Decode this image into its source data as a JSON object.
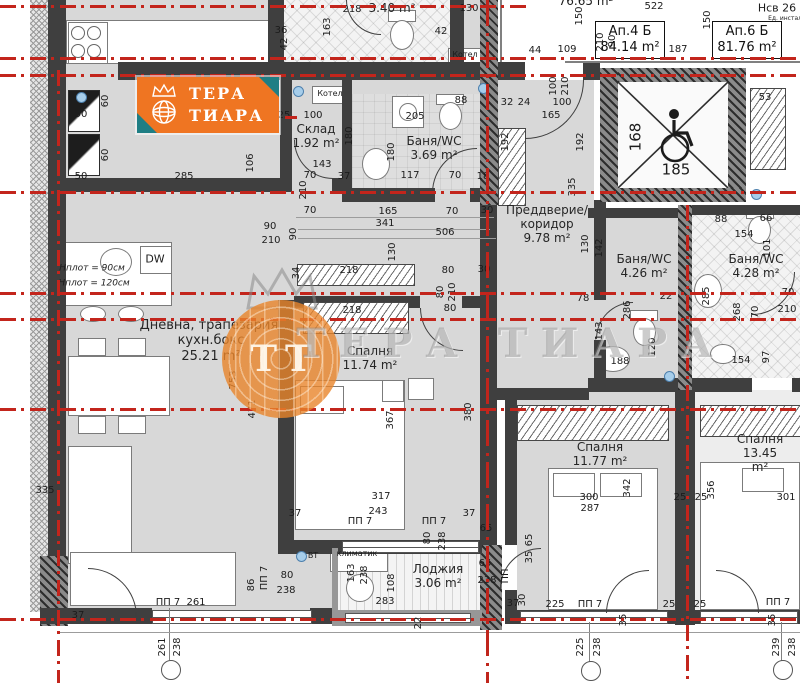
{
  "logo": {
    "line1": "ТЕРА",
    "line2": "ТИАРА"
  },
  "watermark": {
    "initials": "ТТ",
    "text": "ТЕРА ТИАРА"
  },
  "apartments": [
    {
      "name": "Ап.4 Б",
      "area": "84.14 m²"
    },
    {
      "name": "Ап.6 Б",
      "area": "81.76 m²"
    }
  ],
  "rooms": [
    {
      "name": "",
      "area": "3.40 m²",
      "x": 392,
      "y": 1,
      "fs": 12
    },
    {
      "name": "Склад",
      "area": "1.92 m²",
      "x": 316,
      "y": 122,
      "fs": 12
    },
    {
      "name": "Баня/WC",
      "area": "3.69 m²",
      "x": 434,
      "y": 134,
      "fs": 12
    },
    {
      "name": "Преддверие/\nкоридор",
      "area": "9.78 m²",
      "x": 547,
      "y": 203,
      "fs": 12
    },
    {
      "name": "Дневна, трапезария,\nкухн.бокс",
      "area": "25.21 m²",
      "x": 211,
      "y": 318,
      "fs": 13
    },
    {
      "name": "Спалня",
      "area": "11.74 m²",
      "x": 370,
      "y": 344,
      "fs": 12
    },
    {
      "name": "Баня/WC",
      "area": "4.26 m²",
      "x": 644,
      "y": 252,
      "fs": 12
    },
    {
      "name": "Баня/WC",
      "area": "4.28 m²",
      "x": 756,
      "y": 252,
      "fs": 12
    },
    {
      "name": "Спалня",
      "area": "11.77 m²",
      "x": 600,
      "y": 440,
      "fs": 12
    },
    {
      "name": "Спалня",
      "area": "13.45 m²",
      "x": 760,
      "y": 432,
      "fs": 12
    },
    {
      "name": "Лоджия",
      "area": "3.06 m²",
      "x": 438,
      "y": 562,
      "fs": 12
    }
  ],
  "annotations": [
    {
      "t": "218",
      "x": 352,
      "y": 10
    },
    {
      "t": "163",
      "x": 328,
      "y": 27,
      "r": -90
    },
    {
      "t": "130",
      "x": 469,
      "y": 9
    },
    {
      "t": "36",
      "x": 281,
      "y": 31
    },
    {
      "t": "42",
      "x": 285,
      "y": 44,
      "r": -90
    },
    {
      "t": "42",
      "x": 441,
      "y": 32
    },
    {
      "t": "88",
      "x": 461,
      "y": 101
    },
    {
      "t": "100",
      "x": 313,
      "y": 116
    },
    {
      "t": "25",
      "x": 284,
      "y": 116
    },
    {
      "t": "Котел",
      "x": 465,
      "y": 55,
      "s": 8
    },
    {
      "t": "Котел",
      "x": 330,
      "y": 94,
      "s": 8
    },
    {
      "t": "285",
      "x": 184,
      "y": 177
    },
    {
      "t": "60",
      "x": 106,
      "y": 101,
      "r": -90
    },
    {
      "t": "60",
      "x": 106,
      "y": 155,
      "r": -90
    },
    {
      "t": "50",
      "x": 81,
      "y": 115
    },
    {
      "t": "50",
      "x": 81,
      "y": 177
    },
    {
      "t": "106",
      "x": 251,
      "y": 163,
      "r": -90
    },
    {
      "t": "143",
      "x": 322,
      "y": 165
    },
    {
      "t": "70",
      "x": 310,
      "y": 176
    },
    {
      "t": "37",
      "x": 344,
      "y": 177
    },
    {
      "t": "210",
      "x": 304,
      "y": 190,
      "r": -90
    },
    {
      "t": "70",
      "x": 310,
      "y": 211
    },
    {
      "t": "180",
      "x": 350,
      "y": 136,
      "r": -90
    },
    {
      "t": "205",
      "x": 415,
      "y": 117
    },
    {
      "t": "180",
      "x": 392,
      "y": 152,
      "r": -90
    },
    {
      "t": "117",
      "x": 410,
      "y": 176
    },
    {
      "t": "70",
      "x": 455,
      "y": 176
    },
    {
      "t": "18",
      "x": 483,
      "y": 177
    },
    {
      "t": "165",
      "x": 388,
      "y": 212
    },
    {
      "t": "70",
      "x": 452,
      "y": 212
    },
    {
      "t": "30",
      "x": 487,
      "y": 211
    },
    {
      "t": "192",
      "x": 506,
      "y": 142,
      "r": -90
    },
    {
      "t": "192",
      "x": 581,
      "y": 142,
      "r": -90
    },
    {
      "t": "32",
      "x": 507,
      "y": 103
    },
    {
      "t": "24",
      "x": 524,
      "y": 103
    },
    {
      "t": "100",
      "x": 562,
      "y": 103
    },
    {
      "t": "165",
      "x": 551,
      "y": 116
    },
    {
      "t": "100",
      "x": 554,
      "y": 86,
      "r": -90
    },
    {
      "t": "210",
      "x": 566,
      "y": 86,
      "r": -90
    },
    {
      "t": "335",
      "x": 573,
      "y": 187,
      "r": -90
    },
    {
      "t": "130",
      "x": 586,
      "y": 244,
      "r": -90
    },
    {
      "t": "142",
      "x": 600,
      "y": 248,
      "r": -90
    },
    {
      "t": "286",
      "x": 628,
      "y": 310,
      "r": -90
    },
    {
      "t": "143",
      "x": 600,
      "y": 331,
      "r": -90
    },
    {
      "t": "120",
      "x": 653,
      "y": 347,
      "r": -90
    },
    {
      "t": "188",
      "x": 620,
      "y": 362
    },
    {
      "t": "22",
      "x": 666,
      "y": 297
    },
    {
      "t": "78",
      "x": 583,
      "y": 299
    },
    {
      "t": "285",
      "x": 707,
      "y": 296,
      "r": -90
    },
    {
      "t": "154",
      "x": 744,
      "y": 235
    },
    {
      "t": "88",
      "x": 721,
      "y": 220
    },
    {
      "t": "66",
      "x": 766,
      "y": 219
    },
    {
      "t": "101",
      "x": 768,
      "y": 248,
      "r": -90
    },
    {
      "t": "268",
      "x": 738,
      "y": 312,
      "r": -90
    },
    {
      "t": "70",
      "x": 756,
      "y": 312,
      "r": -90
    },
    {
      "t": "70",
      "x": 788,
      "y": 293
    },
    {
      "t": "210",
      "x": 787,
      "y": 310
    },
    {
      "t": "97",
      "x": 767,
      "y": 357,
      "r": -90
    },
    {
      "t": "154",
      "x": 741,
      "y": 361
    },
    {
      "t": "53",
      "x": 765,
      "y": 98
    },
    {
      "t": "168",
      "x": 636,
      "y": 137,
      "r": -90,
      "s": 15
    },
    {
      "t": "185",
      "x": 676,
      "y": 170,
      "s": 15
    },
    {
      "t": "522",
      "x": 654,
      "y": 7
    },
    {
      "t": "150",
      "x": 580,
      "y": 16,
      "r": -90
    },
    {
      "t": "150",
      "x": 708,
      "y": 20,
      "r": -90
    },
    {
      "t": "Нсв 26",
      "x": 777,
      "y": 8,
      "s": 11
    },
    {
      "t": "Ед. инстал.",
      "x": 786,
      "y": 19,
      "s": 6
    },
    {
      "t": "90",
      "x": 613,
      "y": 41,
      "r": -90
    },
    {
      "t": "210",
      "x": 601,
      "y": 42,
      "r": -90
    },
    {
      "t": "187",
      "x": 678,
      "y": 50
    },
    {
      "t": "109",
      "x": 567,
      "y": 50
    },
    {
      "t": "44",
      "x": 535,
      "y": 51
    },
    {
      "t": "76.65 m²",
      "x": 586,
      "y": 1,
      "s": 12
    },
    {
      "t": "90",
      "x": 270,
      "y": 227
    },
    {
      "t": "210",
      "x": 271,
      "y": 241
    },
    {
      "t": "90",
      "x": 294,
      "y": 234,
      "r": -90
    },
    {
      "t": "341",
      "x": 385,
      "y": 224
    },
    {
      "t": "506",
      "x": 445,
      "y": 233
    },
    {
      "t": "130",
      "x": 393,
      "y": 252,
      "r": -90
    },
    {
      "t": "34",
      "x": 297,
      "y": 273,
      "r": -90
    },
    {
      "t": "218",
      "x": 349,
      "y": 271
    },
    {
      "t": "80",
      "x": 448,
      "y": 271
    },
    {
      "t": "30",
      "x": 484,
      "y": 270
    },
    {
      "t": "80",
      "x": 441,
      "y": 292,
      "r": -90
    },
    {
      "t": "210",
      "x": 453,
      "y": 292,
      "r": -90
    },
    {
      "t": "218",
      "x": 352,
      "y": 311
    },
    {
      "t": "80",
      "x": 450,
      "y": 309
    },
    {
      "t": "471",
      "x": 253,
      "y": 409,
      "r": -90
    },
    {
      "t": "367",
      "x": 391,
      "y": 420,
      "r": -90
    },
    {
      "t": "380",
      "x": 469,
      "y": 412,
      "r": -90
    },
    {
      "t": "753",
      "x": 234,
      "y": 380,
      "r": -90
    },
    {
      "t": "335",
      "x": 45,
      "y": 491
    },
    {
      "t": "Hплот = 90см",
      "x": 92,
      "y": 269,
      "s": 9,
      "i": 1
    },
    {
      "t": "Hплот = 120см",
      "x": 94,
      "y": 284,
      "s": 9,
      "i": 1
    },
    {
      "t": "DW",
      "x": 155,
      "y": 259,
      "s": 11
    },
    {
      "t": "317",
      "x": 381,
      "y": 497
    },
    {
      "t": "243",
      "x": 378,
      "y": 512
    },
    {
      "t": "37",
      "x": 295,
      "y": 514
    },
    {
      "t": "37",
      "x": 469,
      "y": 514
    },
    {
      "t": "ПП 7",
      "x": 360,
      "y": 522
    },
    {
      "t": "ПП 7",
      "x": 434,
      "y": 522
    },
    {
      "t": "80",
      "x": 428,
      "y": 538,
      "r": -90
    },
    {
      "t": "238",
      "x": 443,
      "y": 541,
      "r": -90
    },
    {
      "t": "65",
      "x": 486,
      "y": 529
    },
    {
      "t": "65",
      "x": 485,
      "y": 564
    },
    {
      "t": "238",
      "x": 487,
      "y": 581
    },
    {
      "t": "ПП",
      "x": 506,
      "y": 576,
      "r": -90
    },
    {
      "t": "климатик",
      "x": 357,
      "y": 554,
      "s": 8
    },
    {
      "t": "163",
      "x": 352,
      "y": 573,
      "r": -90
    },
    {
      "t": "238",
      "x": 365,
      "y": 575,
      "r": -90
    },
    {
      "t": "108",
      "x": 392,
      "y": 583,
      "r": -90
    },
    {
      "t": "283",
      "x": 385,
      "y": 602
    },
    {
      "t": "22",
      "x": 419,
      "y": 623,
      "r": -90
    },
    {
      "t": "37",
      "x": 513,
      "y": 604
    },
    {
      "t": "30",
      "x": 523,
      "y": 600,
      "r": -90
    },
    {
      "t": "65",
      "x": 530,
      "y": 540,
      "r": -90
    },
    {
      "t": "35",
      "x": 530,
      "y": 557,
      "r": -90
    },
    {
      "t": "86",
      "x": 252,
      "y": 585,
      "r": -90
    },
    {
      "t": "ПП 7",
      "x": 265,
      "y": 578,
      "r": -90
    },
    {
      "t": "80",
      "x": 287,
      "y": 576
    },
    {
      "t": "238",
      "x": 286,
      "y": 591
    },
    {
      "t": "ПП 7",
      "x": 168,
      "y": 603
    },
    {
      "t": "261",
      "x": 196,
      "y": 603
    },
    {
      "t": "37",
      "x": 78,
      "y": 616
    },
    {
      "t": "261",
      "x": 163,
      "y": 647,
      "r": -90
    },
    {
      "t": "238",
      "x": 178,
      "y": 647,
      "r": -90
    },
    {
      "t": "225",
      "x": 555,
      "y": 605
    },
    {
      "t": "ПП 7",
      "x": 590,
      "y": 605
    },
    {
      "t": "25",
      "x": 669,
      "y": 605
    },
    {
      "t": "25",
      "x": 700,
      "y": 605
    },
    {
      "t": "ПП 7",
      "x": 778,
      "y": 603
    },
    {
      "t": "35",
      "x": 624,
      "y": 620,
      "r": -90
    },
    {
      "t": "35",
      "x": 773,
      "y": 620,
      "r": -90
    },
    {
      "t": "225",
      "x": 581,
      "y": 647,
      "r": -90
    },
    {
      "t": "238",
      "x": 598,
      "y": 647,
      "r": -90
    },
    {
      "t": "239",
      "x": 777,
      "y": 647,
      "r": -90
    },
    {
      "t": "238",
      "x": 793,
      "y": 647,
      "r": -90
    },
    {
      "t": "342",
      "x": 628,
      "y": 488,
      "r": -90
    },
    {
      "t": "300",
      "x": 589,
      "y": 498
    },
    {
      "t": "287",
      "x": 590,
      "y": 509
    },
    {
      "t": "25",
      "x": 680,
      "y": 498
    },
    {
      "t": "25",
      "x": 701,
      "y": 498
    },
    {
      "t": "356",
      "x": 712,
      "y": 490,
      "r": -90
    },
    {
      "t": "301",
      "x": 786,
      "y": 498
    },
    {
      "t": "ВТ",
      "x": 313,
      "y": 556,
      "s": 8
    }
  ],
  "colors": {
    "red": "#c3251c",
    "orange": "#ef7522",
    "teal": "#1f7e84",
    "wall": "#3f3f3f",
    "floor": "#d8d8d8"
  }
}
